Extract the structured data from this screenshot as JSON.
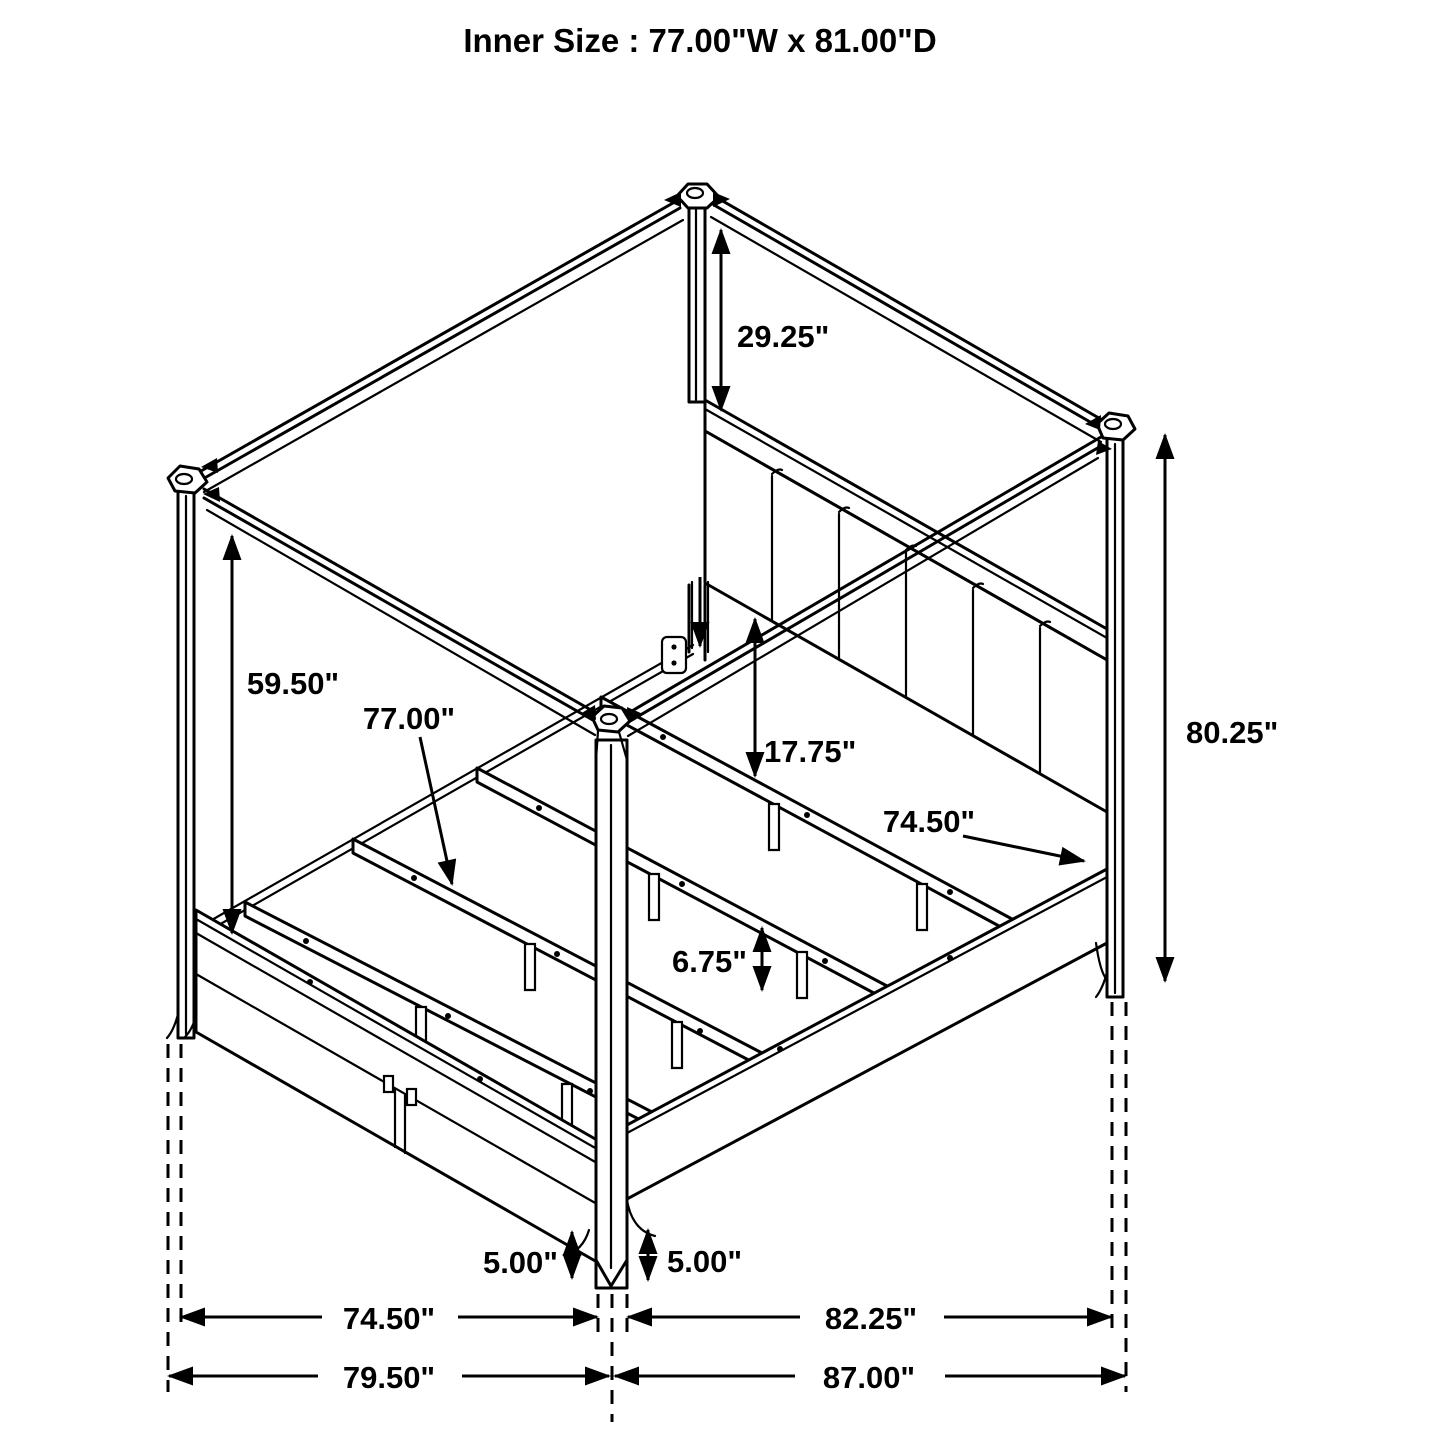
{
  "title": "Inner Size : 77.00\"W x 81.00\"D",
  "dimensions": {
    "post_above_headboard": "29.25\"",
    "canopy_clearance": "59.50\"",
    "slat_length": "77.00\"",
    "headboard_to_deck": "17.75\"",
    "side_rail_length": "74.50\"",
    "post_height": "80.25\"",
    "slat_leg_height": "6.75\"",
    "foot_height_left": "5.00\"",
    "foot_height_right": "5.00\"",
    "footboard_span_inner": "74.50\"",
    "siderail_span_inner": "82.25\"",
    "overall_width": "79.50\"",
    "overall_depth": "87.00\""
  },
  "colors": {
    "line": "#000000",
    "background": "#ffffff",
    "text": "#000000"
  }
}
